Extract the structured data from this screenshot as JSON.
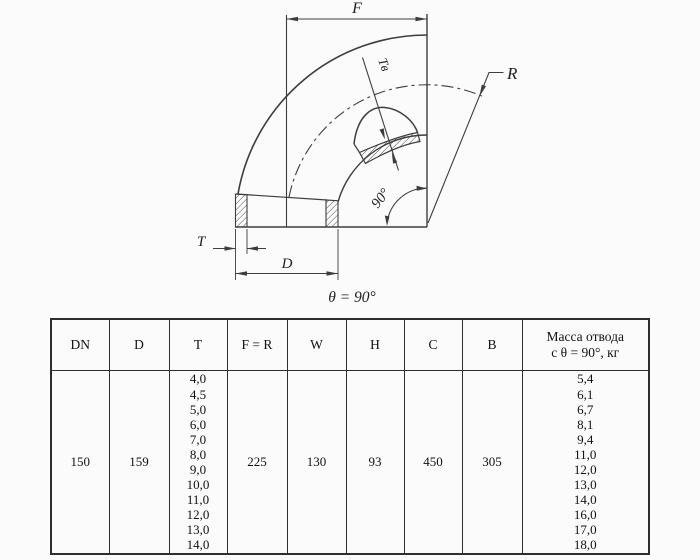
{
  "drawing": {
    "labels": {
      "f": "F",
      "r": "R",
      "t": "T",
      "d": "D",
      "tv": "Tв",
      "angle": "90°",
      "caption": "θ = 90°"
    },
    "stroke_color": "#3d3d3d"
  },
  "table": {
    "columns": [
      {
        "key": "dn",
        "header": "DN",
        "value": "150"
      },
      {
        "key": "d",
        "header": "D",
        "value": "159"
      },
      {
        "key": "t",
        "header": "T",
        "values": [
          "4,0",
          "4,5",
          "5,0",
          "6,0",
          "7,0",
          "8,0",
          "9,0",
          "10,0",
          "11,0",
          "12,0",
          "13,0",
          "14,0"
        ]
      },
      {
        "key": "fr",
        "header": "F = R",
        "value": "225"
      },
      {
        "key": "w",
        "header": "W",
        "value": "130"
      },
      {
        "key": "h",
        "header": "H",
        "value": "93"
      },
      {
        "key": "c",
        "header": "C",
        "value": "450"
      },
      {
        "key": "b",
        "header": "B",
        "value": "305"
      },
      {
        "key": "mass",
        "header": [
          "Масса отвода",
          "с θ =  90°, кг"
        ],
        "values": [
          "5,4",
          "6,1",
          "6,7",
          "8,1",
          "9,4",
          "11,0",
          "12,0",
          "13,0",
          "14,0",
          "16,0",
          "17,0",
          "18,0"
        ]
      }
    ]
  }
}
